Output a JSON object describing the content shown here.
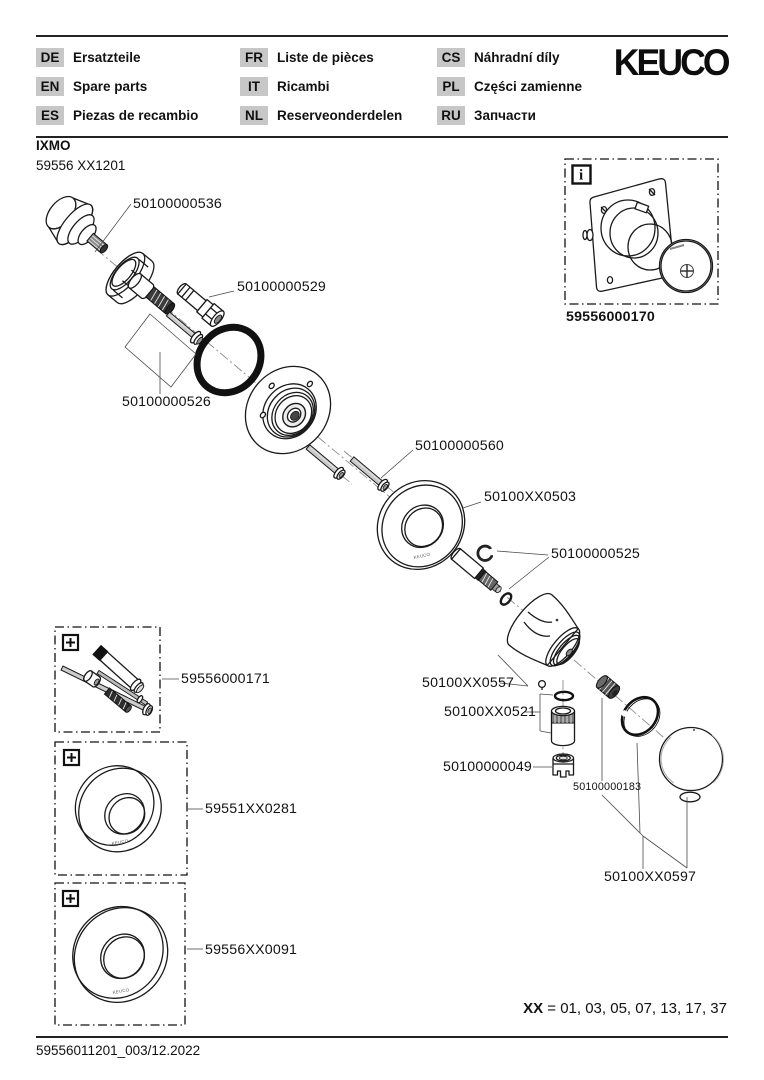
{
  "header": {
    "brand": "KEUCO",
    "languages": [
      {
        "code": "DE",
        "label": "Ersatzteile"
      },
      {
        "code": "EN",
        "label": "Spare parts"
      },
      {
        "code": "ES",
        "label": "Piezas de recambio"
      },
      {
        "code": "FR",
        "label": "Liste de pièces"
      },
      {
        "code": "IT",
        "label": "Ricambi"
      },
      {
        "code": "NL",
        "label": "Reserveonderdelen"
      },
      {
        "code": "CS",
        "label": "Náhradní díly"
      },
      {
        "code": "PL",
        "label": "Części zamienne"
      },
      {
        "code": "RU",
        "label": "Запчасти"
      }
    ]
  },
  "product": {
    "series": "IXMO",
    "model": "59556 XX1201"
  },
  "diagram": {
    "labels": {
      "cartridge": "50100000536",
      "plug_screw": "50100000529",
      "extension_parts": "50100000526",
      "screws": "50100000560",
      "escutcheon": "50100XX0503",
      "spindle_set": "50100000525",
      "handle_base": "50100XX0557",
      "sleeve": "50100XX0521",
      "check_valve": "50100000049",
      "retaining_ring": "50100000183",
      "handle": "50100XX0597"
    },
    "info_box": {
      "icon": "i",
      "part": "59556000170"
    },
    "addon_boxes": [
      {
        "icon": "+",
        "part": "59556000171"
      },
      {
        "icon": "+",
        "part": "59551XX0281"
      },
      {
        "icon": "+",
        "part": "59556XX0091"
      }
    ],
    "engraving": "KEUCO"
  },
  "variants": {
    "label": "XX",
    "rest": "= 01, 03, 05, 07, 13, 17, 37"
  },
  "footer": {
    "doc_id": "59556011201_003/12.2022"
  }
}
